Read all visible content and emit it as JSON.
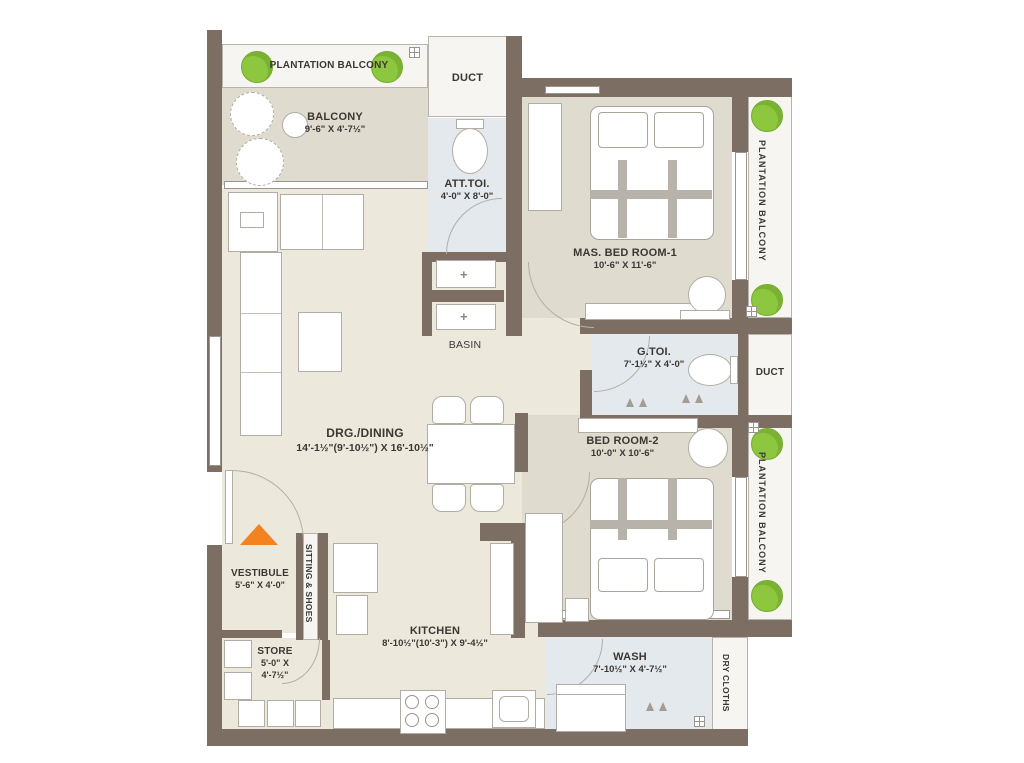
{
  "colors": {
    "wall": "#7d6e63",
    "floor_living": "#ece9dc",
    "floor_bedroom": "#dfdbcf",
    "floor_toilet": "#e4e9ee",
    "tree_green": "#8dc63f",
    "entry_arrow_orange": "#f58220",
    "label_text": "#3b3733"
  },
  "rooms": {
    "plantation_top": {
      "label": "PLANTATION BALCONY"
    },
    "balcony": {
      "label": "BALCONY",
      "dims": "9'-6\" X 4'-7½\""
    },
    "duct_top": {
      "label": "DUCT"
    },
    "att_toi": {
      "label": "ATT.TOI.",
      "dims": "4'-0\" X 8'-0\""
    },
    "basin": {
      "label": "BASIN"
    },
    "mas_bedroom": {
      "label": "MAS. BED ROOM-1",
      "dims": "10'-6\" X 11'-6\""
    },
    "plantation_right_top": {
      "label": "PLANTATION BALCONY"
    },
    "g_toi": {
      "label": "G.TOI.",
      "dims": "7'-1½\" X 4'-0\""
    },
    "duct_right": {
      "label": "DUCT"
    },
    "drg_dining": {
      "label": "DRG./DINING",
      "dims": "14'-1½\"(9'-10½\") X 16'-10½\""
    },
    "bed_room_2": {
      "label": "BED ROOM-2",
      "dims": "10'-0\" X 10'-6\""
    },
    "plantation_right_bottom": {
      "label": "PLANTATION BALCONY"
    },
    "vestibule": {
      "label": "VESTIBULE",
      "dims": "5'-6\" X 4'-0\""
    },
    "sitting_shoes": {
      "label": "SITTING & SHOES"
    },
    "store": {
      "label": "STORE",
      "dims_line1": "5'-0\" X",
      "dims_line2": "4'-7½\""
    },
    "kitchen": {
      "label": "KITCHEN",
      "dims": "8'-10½\"(10'-3\") X 9'-4½\""
    },
    "wash": {
      "label": "WASH",
      "dims": "7'-10½\" X  4'-7½\""
    },
    "dry_cloths": {
      "label": "DRY CLOTHS"
    }
  }
}
